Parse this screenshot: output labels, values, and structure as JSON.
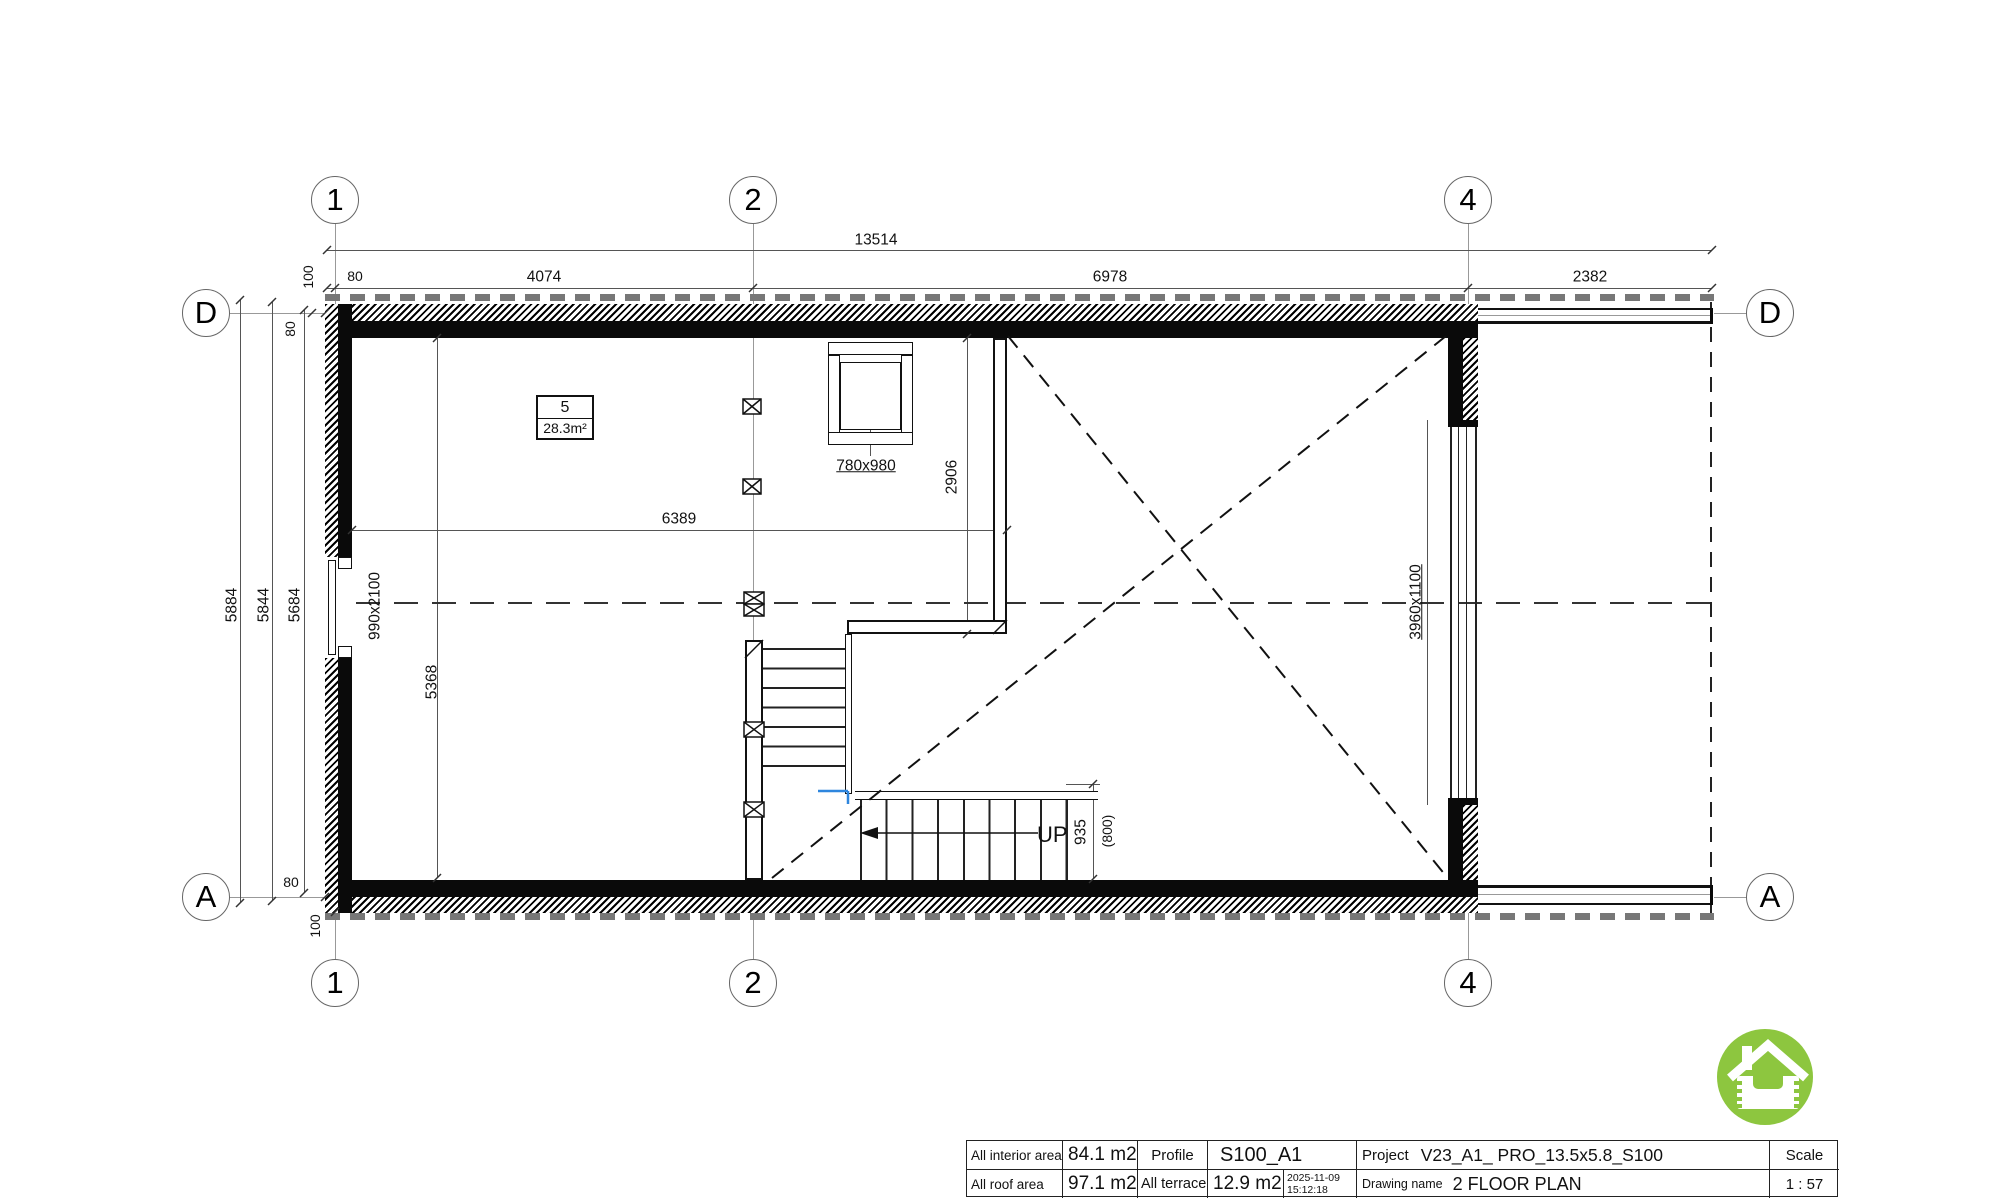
{
  "grid": {
    "col1": "1",
    "col2": "2",
    "col4": "4",
    "rowD": "D",
    "rowA": "A"
  },
  "dims": {
    "overall": "13514",
    "seg80": "80",
    "seg4074": "4074",
    "seg6978": "6978",
    "seg2382": "2382",
    "off100_top": "100",
    "left5884": "5884",
    "left5844": "5844",
    "left5684": "5684",
    "offD80": "80",
    "offA80": "80",
    "off100_bottom": "100",
    "door_left": "990x2100",
    "interior_width": "6389",
    "interior_height": "5368",
    "stair_opening": "2906",
    "roof_window": "780x980",
    "window_right": "3960x1100",
    "stair_width": "935",
    "stair_width_alt": "(800)"
  },
  "room": {
    "number": "5",
    "area": "28.3m²"
  },
  "stairs": {
    "up_label": "UP"
  },
  "titleblock": {
    "interior_area_label": "All interior area",
    "interior_area_value": "84.1 m2",
    "roof_area_label": "All roof area",
    "roof_area_value": "97.1 m2",
    "profile_label": "Profile",
    "profile_value": "S100_A1",
    "terrace_label": "All terrace",
    "terrace_value": "12.9 m2",
    "date": "2025-11-09",
    "time": "15:12:18",
    "project_label": "Project",
    "project_value": "V23_A1_ PRO_13.5x5.8_S100",
    "drawing_label": "Drawing name",
    "drawing_value": "2 FLOOR PLAN",
    "scale_label": "Scale",
    "scale_value": "1 : 57"
  },
  "colors": {
    "logo_green": "#8dc63f",
    "stair_marker_blue": "#2e86de",
    "wall_black": "#0a0a0a",
    "dim_gray": "#555555"
  }
}
